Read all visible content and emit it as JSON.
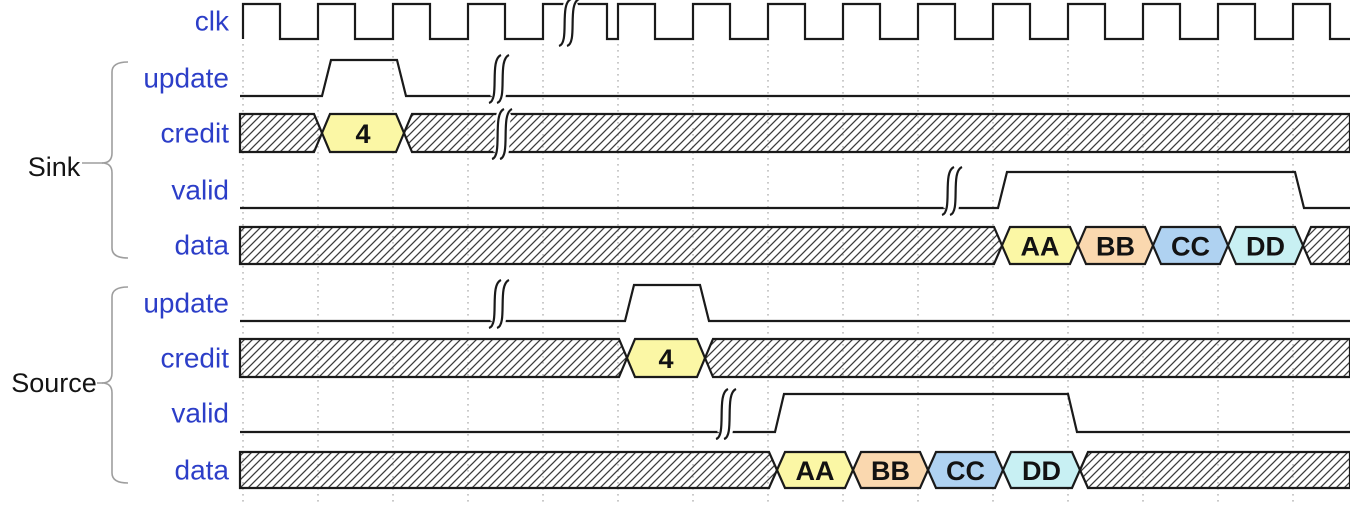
{
  "diagram": {
    "kind": "timing-waveform",
    "groups": [
      {
        "label": "Sink"
      },
      {
        "label": "Source"
      }
    ],
    "colors": {
      "background": "#FFFFFF",
      "signal_label": "#2C3EC8",
      "group_label": "#141414",
      "wave_line": "#1A1A1A",
      "grid_dots": "#ADADAD",
      "brace": "#9E9E9E",
      "block_text": "#121212",
      "yellow": "#FBF7A5",
      "orange": "#FAD8AF",
      "blue": "#AFD2F1",
      "cyan": "#C8F0F3",
      "hatch_line": "#3C3C3C"
    },
    "grid": {
      "x0": 243,
      "dx": 75,
      "count": 15,
      "y0": 44,
      "y1": 504
    },
    "signals": [
      {
        "id": "clk",
        "label": "clk",
        "group": null,
        "type": "clock",
        "yTop": 4,
        "yBot": 39,
        "highs": [
          [
            243,
            280
          ],
          [
            318,
            355
          ],
          [
            393,
            430
          ],
          [
            468,
            505
          ],
          [
            543,
            607
          ],
          [
            618,
            655
          ],
          [
            693,
            730
          ],
          [
            768,
            805
          ],
          [
            843,
            880
          ],
          [
            918,
            955
          ],
          [
            993,
            1030
          ],
          [
            1068,
            1105
          ],
          [
            1143,
            1180
          ],
          [
            1218,
            1255
          ],
          [
            1293,
            1330
          ]
        ],
        "breaks": [
          572
        ]
      },
      {
        "id": "sink-update",
        "label": "update",
        "group": "Sink",
        "type": "binary",
        "yTop": 60,
        "yBot": 96,
        "pulses": [
          [
            322,
            397
          ]
        ],
        "breaks": [
          502
        ]
      },
      {
        "id": "sink-credit",
        "label": "credit",
        "group": "Sink",
        "type": "bus",
        "yTop": 114,
        "yBot": 152,
        "blocks": [
          {
            "kind": "hatch",
            "from": 240,
            "to": 322
          },
          {
            "kind": "value",
            "text": "4",
            "color": "yellow",
            "from": 322,
            "to": 404
          },
          {
            "kind": "hatch",
            "from": 404,
            "to": 1350
          }
        ],
        "breaks": [
          505
        ]
      },
      {
        "id": "sink-valid",
        "label": "valid",
        "group": "Sink",
        "type": "binary",
        "yTop": 172,
        "yBot": 208,
        "pulses": [
          [
            998,
            1295
          ]
        ],
        "breaks": [
          955
        ]
      },
      {
        "id": "sink-data",
        "label": "data",
        "group": "Sink",
        "type": "bus",
        "yTop": 227,
        "yBot": 264,
        "blocks": [
          {
            "kind": "hatch",
            "from": 240,
            "to": 1002
          },
          {
            "kind": "value",
            "text": "AA",
            "color": "yellow",
            "from": 1002,
            "to": 1078
          },
          {
            "kind": "value",
            "text": "BB",
            "color": "orange",
            "from": 1078,
            "to": 1153
          },
          {
            "kind": "value",
            "text": "CC",
            "color": "blue",
            "from": 1153,
            "to": 1228
          },
          {
            "kind": "value",
            "text": "DD",
            "color": "cyan",
            "from": 1228,
            "to": 1303
          },
          {
            "kind": "hatch",
            "from": 1303,
            "to": 1350
          }
        ],
        "breaks": []
      },
      {
        "id": "source-update",
        "label": "update",
        "group": "Source",
        "type": "binary",
        "yTop": 285,
        "yBot": 321,
        "pulses": [
          [
            625,
            700
          ]
        ],
        "breaks": [
          502
        ]
      },
      {
        "id": "source-credit",
        "label": "credit",
        "group": "Source",
        "type": "bus",
        "yTop": 339,
        "yBot": 377,
        "blocks": [
          {
            "kind": "hatch",
            "from": 240,
            "to": 627
          },
          {
            "kind": "value",
            "text": "4",
            "color": "yellow",
            "from": 627,
            "to": 705
          },
          {
            "kind": "hatch",
            "from": 705,
            "to": 1350
          }
        ],
        "breaks": []
      },
      {
        "id": "source-valid",
        "label": "valid",
        "group": "Source",
        "type": "binary",
        "yTop": 394,
        "yBot": 432,
        "pulses": [
          [
            775,
            1068
          ]
        ],
        "breaks": [
          729
        ]
      },
      {
        "id": "source-data",
        "label": "data",
        "group": "Source",
        "type": "bus",
        "yTop": 452,
        "yBot": 488,
        "blocks": [
          {
            "kind": "hatch",
            "from": 240,
            "to": 777
          },
          {
            "kind": "value",
            "text": "AA",
            "color": "yellow",
            "from": 777,
            "to": 853
          },
          {
            "kind": "value",
            "text": "BB",
            "color": "orange",
            "from": 853,
            "to": 928
          },
          {
            "kind": "value",
            "text": "CC",
            "color": "blue",
            "from": 928,
            "to": 1003
          },
          {
            "kind": "value",
            "text": "DD",
            "color": "cyan",
            "from": 1003,
            "to": 1080
          },
          {
            "kind": "hatch",
            "from": 1080,
            "to": 1350
          }
        ],
        "breaks": []
      }
    ]
  }
}
